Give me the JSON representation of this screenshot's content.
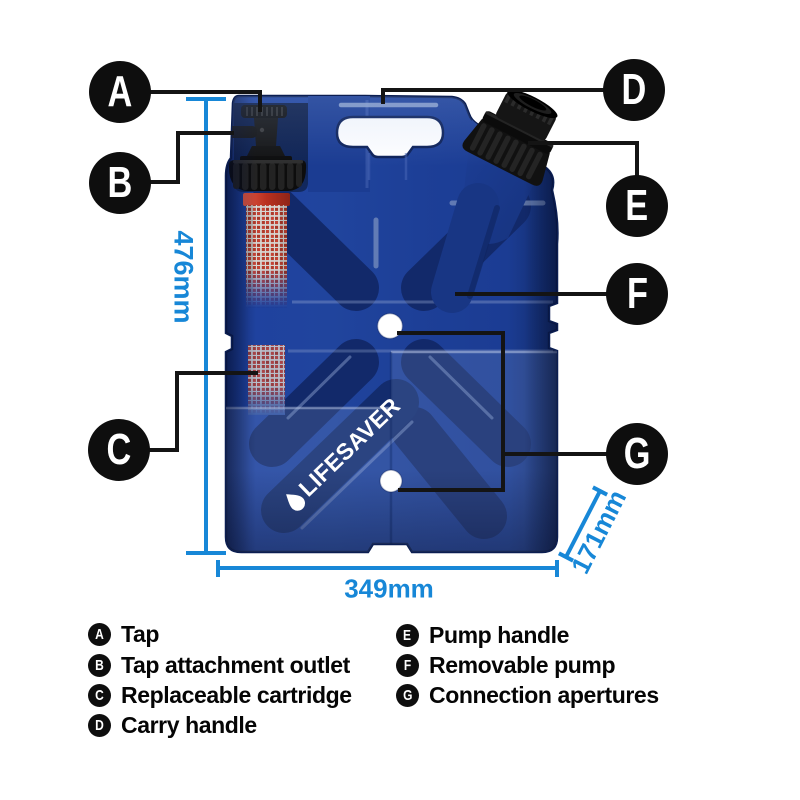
{
  "figure": {
    "type": "product-dimension-diagram",
    "brand_logo": "LIFESAVER",
    "dimensions": {
      "height": "476mm",
      "width": "349mm",
      "depth": "171mm"
    },
    "legend": {
      "items": [
        {
          "letter": "A",
          "label": "Tap"
        },
        {
          "letter": "B",
          "label": "Tap attachment outlet"
        },
        {
          "letter": "C",
          "label": "Replaceable cartridge"
        },
        {
          "letter": "D",
          "label": "Carry handle"
        },
        {
          "letter": "E",
          "label": "Pump handle"
        },
        {
          "letter": "F",
          "label": "Removable pump"
        },
        {
          "letter": "G",
          "label": "Connection apertures"
        }
      ]
    },
    "colors": {
      "body_blue": "#1e419f",
      "shadow_navy": "#12296a",
      "dimension_blue": "#1787d7",
      "cartridge_red": "#c0392c",
      "callout_black": "#0e0e0e"
    }
  }
}
